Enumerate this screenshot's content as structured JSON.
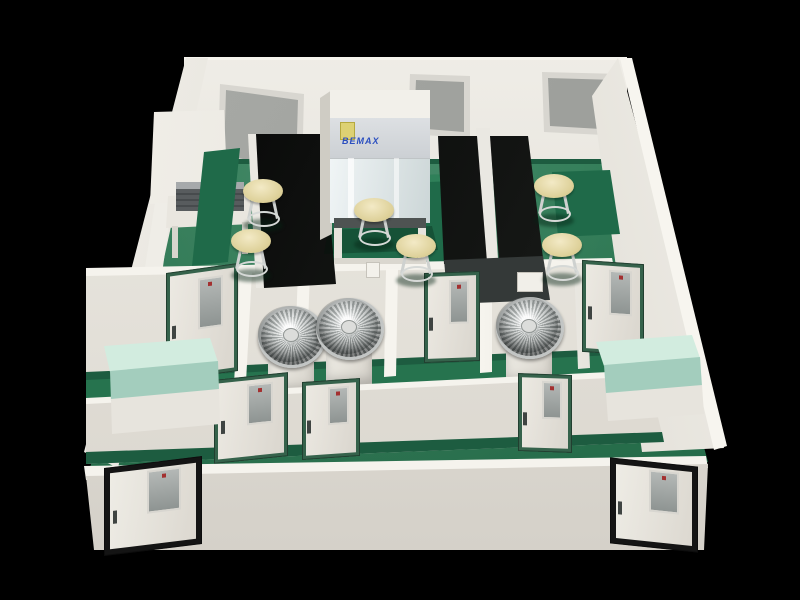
{
  "scene": {
    "description": "3D cutaway rendering of a laboratory floor plan",
    "cabinet": {
      "brand_label": "BEMAX",
      "label_color": "#2b4fc0",
      "sticker_color": "#ddd173"
    },
    "colors": {
      "background": "#000000",
      "floor_green": "#2a7550",
      "wall_cream": "#e9e6df",
      "baseboard_green": "#1d5c40",
      "bench_black": "#0b0c0b",
      "counter_mint": "#d2ecdf",
      "stool_seat_cream": "#e8ddb0",
      "interior_door_frame": "#35624b",
      "exterior_door_frame": "#141414",
      "window_glass_gray": "#a2a4a0"
    },
    "objects": {
      "windows": 3,
      "stools": 6,
      "fan_units": 3,
      "interior_doors": 6,
      "exterior_doors": 2,
      "black_benches": 3,
      "mint_counters": 2,
      "biosafety_cabinets": 1
    }
  }
}
